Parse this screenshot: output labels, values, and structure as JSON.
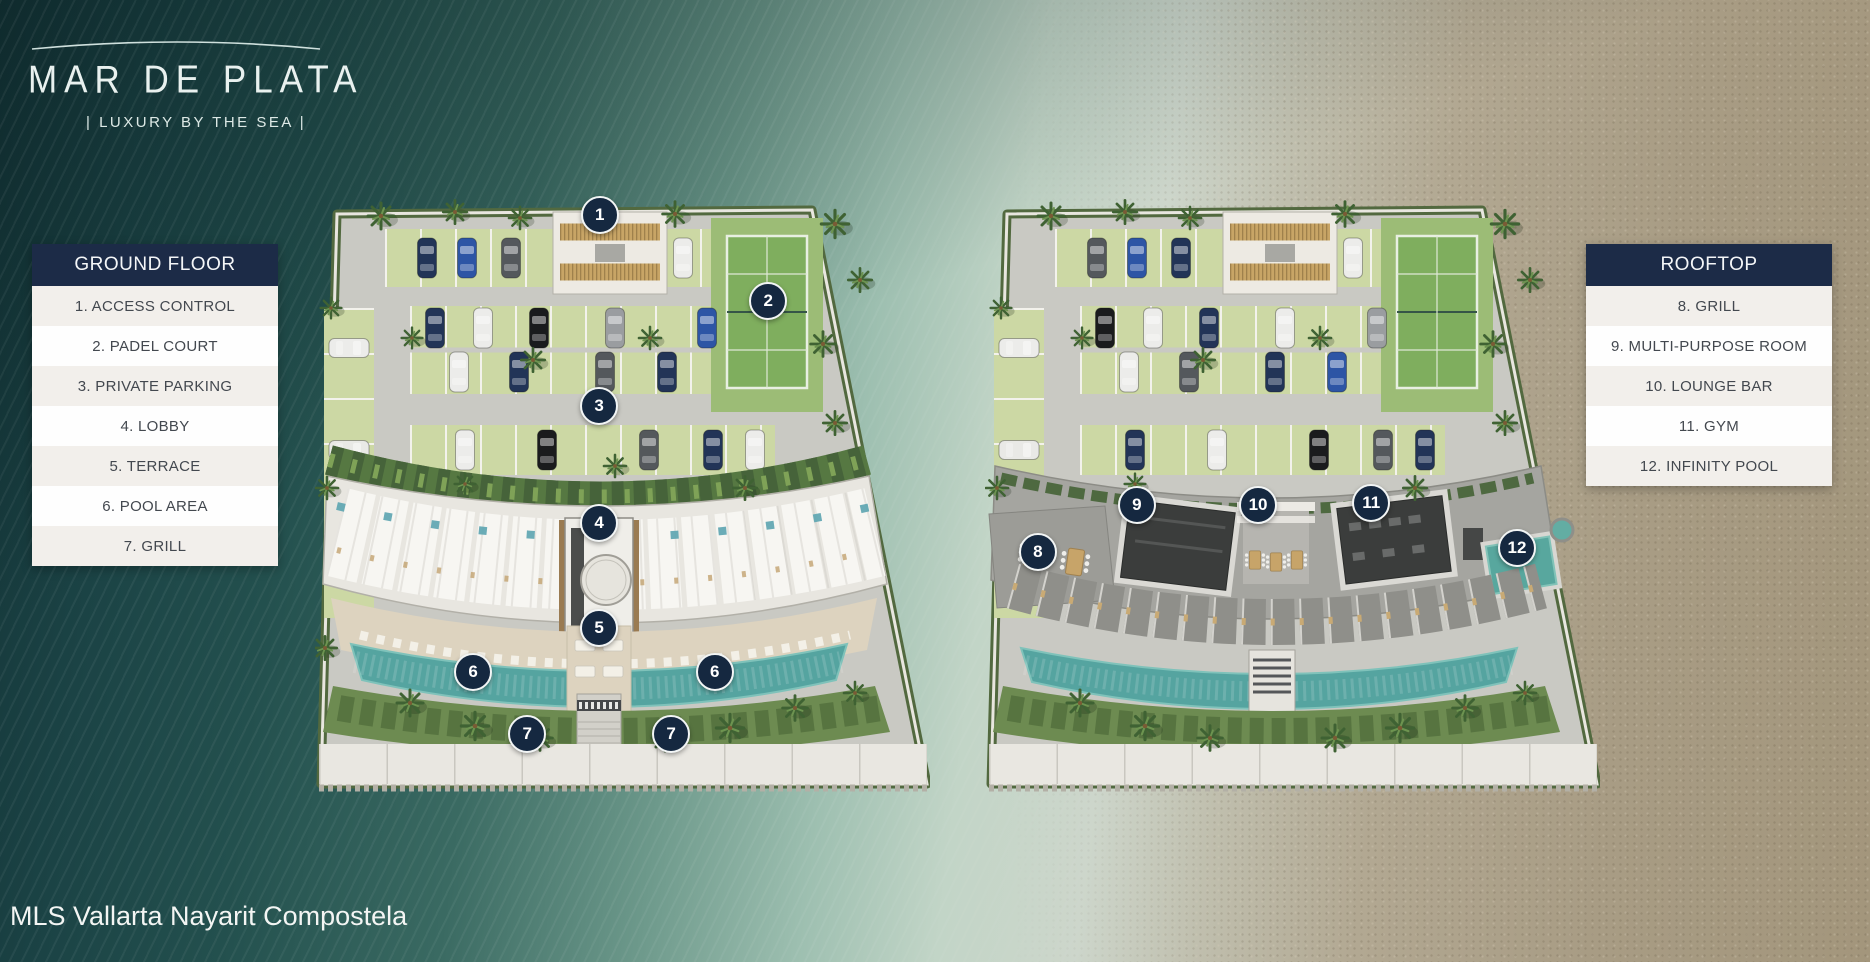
{
  "brand": {
    "title": "MAR DE PLATA",
    "tagline": "| LUXURY BY THE SEA |"
  },
  "footer": {
    "text": "MLS Vallarta Nayarit Compostela"
  },
  "legends": [
    {
      "title": "GROUND FLOOR",
      "items": [
        "1. ACCESS CONTROL",
        "2. PADEL COURT",
        "3. PRIVATE PARKING",
        "4. LOBBY",
        "5. TERRACE",
        "6. POOL AREA",
        "7. GRILL"
      ]
    },
    {
      "title": "ROOFTOP",
      "items": [
        "8. GRILL",
        "9. MULTI-PURPOSE ROOM",
        "10. LOUNGE BAR",
        "11. GYM",
        "12. INFINITY POOL"
      ]
    }
  ],
  "plans": [
    {
      "label": "ground-floor-site-plan",
      "markers": [
        {
          "n": "1",
          "x": 46.3,
          "y": 4.4
        },
        {
          "n": "2",
          "x": 73.7,
          "y": 18.3
        },
        {
          "n": "3",
          "x": 46.2,
          "y": 35.3
        },
        {
          "n": "4",
          "x": 46.2,
          "y": 54.2
        },
        {
          "n": "5",
          "x": 46.2,
          "y": 71.2
        },
        {
          "n": "6",
          "x": 25.7,
          "y": 78.3
        },
        {
          "n": "6",
          "x": 65.0,
          "y": 78.3
        },
        {
          "n": "7",
          "x": 34.5,
          "y": 88.3
        },
        {
          "n": "7",
          "x": 57.9,
          "y": 88.3
        }
      ]
    },
    {
      "label": "rooftop-site-plan",
      "markers": [
        {
          "n": "8",
          "x": 8.6,
          "y": 58.9
        },
        {
          "n": "9",
          "x": 24.7,
          "y": 51.3
        },
        {
          "n": "10",
          "x": 44.4,
          "y": 51.3
        },
        {
          "n": "11",
          "x": 62.8,
          "y": 51.0
        },
        {
          "n": "12",
          "x": 86.5,
          "y": 58.3
        }
      ]
    }
  ],
  "colors": {
    "header_navy": "#1c2b47",
    "marker_navy": "#152840",
    "row_beige": "#f2efeb",
    "row_white": "#fefefe",
    "pool_teal": "#55a49f",
    "court_green": "#7fae5e",
    "ocean_dark": "#1b4345",
    "sand": "#a89c84"
  }
}
